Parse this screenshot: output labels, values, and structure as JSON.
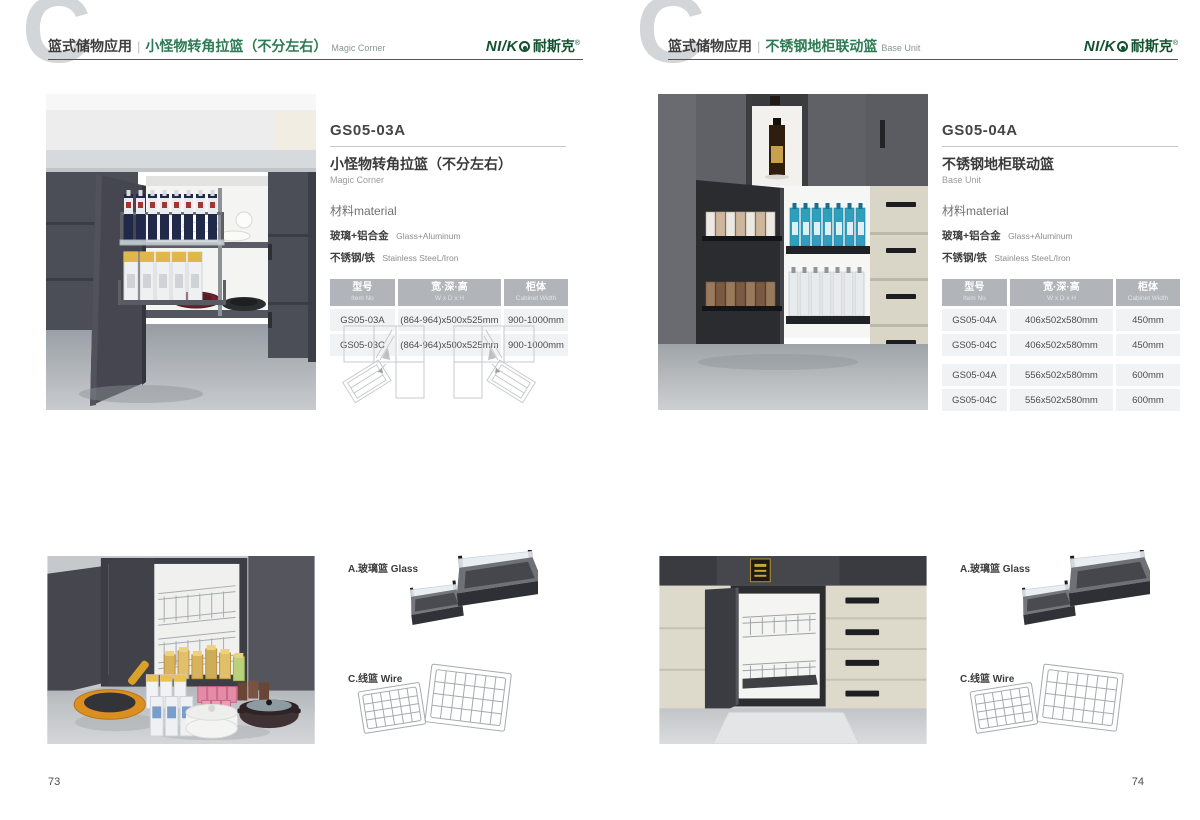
{
  "colors": {
    "accent_green": "#2e7a54",
    "logo_green": "#14522f",
    "table_header_bg": "#b1b5b9",
    "table_row_bg": "#f1f2f3",
    "watermark_gray": "#d3d6d9"
  },
  "watermark_letter": "C",
  "logo": {
    "latin": "NI/K",
    "cn": "耐斯克",
    "reg": "®"
  },
  "left_page": {
    "page_number": "73",
    "header": {
      "category": "篮式储物应用",
      "separator": "|",
      "title_cn": "小怪物转角拉篮（不分左右）",
      "title_en": "Magic Corner"
    },
    "product": {
      "model": "GS05-03A",
      "name_cn": "小怪物转角拉篮（不分左右）",
      "name_en": "Magic Corner",
      "material_label": "材料material",
      "materials": [
        {
          "cn": "玻璃+铝合金",
          "en": "Glass+Aluminum"
        },
        {
          "cn": "不锈钢/铁",
          "en": "Stainless SteeL/Iron"
        }
      ],
      "table": {
        "headers": [
          {
            "cn": "型号",
            "en": "Item No"
          },
          {
            "cn": "宽·深·高",
            "en": "W x D x H"
          },
          {
            "cn": "柜体",
            "en": "Cabinet Width"
          }
        ],
        "rows": [
          [
            "GS05-03A",
            "(864-964)x500x525mm",
            "900-1000mm"
          ],
          [
            "GS05-03C",
            "(864-964)x500x525mm",
            "900-1000mm"
          ]
        ]
      }
    },
    "accessories": {
      "glass_label": "A.玻璃篮 Glass",
      "wire_label": "C.线篮 Wire"
    }
  },
  "right_page": {
    "page_number": "74",
    "header": {
      "category": "篮式储物应用",
      "separator": "|",
      "title_cn": "不锈钢地柜联动篮",
      "title_en": "Base Unit"
    },
    "product": {
      "model": "GS05-04A",
      "name_cn": "不锈钢地柜联动篮",
      "name_en": "Base Unit",
      "material_label": "材料material",
      "materials": [
        {
          "cn": "玻璃+铝合金",
          "en": "Glass+Aluminum"
        },
        {
          "cn": "不锈钢/铁",
          "en": "Stainless SteeL/Iron"
        }
      ],
      "table": {
        "headers": [
          {
            "cn": "型号",
            "en": "Item No"
          },
          {
            "cn": "宽·深·高",
            "en": "W x D x H"
          },
          {
            "cn": "柜体",
            "en": "Cabinet Width"
          }
        ],
        "rows": [
          [
            "GS05-04A",
            "406x502x580mm",
            "450mm"
          ],
          [
            "GS05-04C",
            "406x502x580mm",
            "450mm"
          ],
          [
            "GS05-04A",
            "556x502x580mm",
            "600mm"
          ],
          [
            "GS05-04C",
            "556x502x580mm",
            "600mm"
          ]
        ]
      }
    },
    "accessories": {
      "glass_label": "A.玻璃篮 Glass",
      "wire_label": "C.线篮 Wire"
    }
  }
}
